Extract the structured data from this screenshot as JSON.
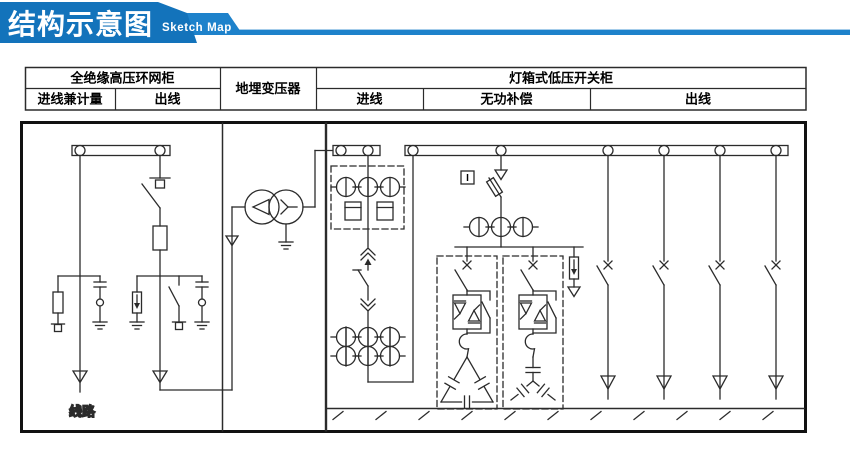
{
  "banner": {
    "title": "结构示意图",
    "subtitle": "Sketch Map",
    "colors": {
      "primary": "#1373BB",
      "secondary": "#1E82CB"
    }
  },
  "table": {
    "row1": {
      "hv_cabinet": "全绝缘高压环网柜",
      "transformer": "地埋变压器",
      "lv_cabinet": "灯箱式低压开关柜"
    },
    "row2": {
      "hv_incoming": "进线兼计量",
      "hv_outgoing": "出线",
      "lv_incoming": "进线",
      "compensation": "无功补偿",
      "lv_outgoing": "出线"
    }
  },
  "diagram": {
    "labels": {
      "line": "线路",
      "indicator": "I"
    },
    "colors": {
      "line": "#2b2b2b",
      "border": "#111111"
    }
  }
}
